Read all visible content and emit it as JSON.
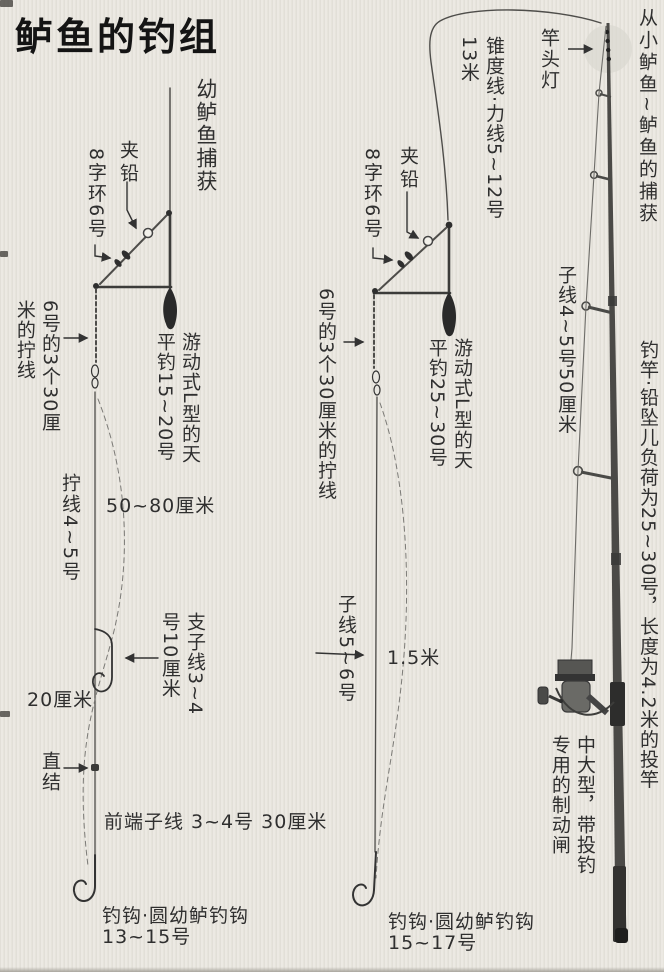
{
  "page": {
    "title": "鲈鱼的钓组"
  },
  "colors": {
    "paper": "#ebe8e1",
    "ink": "#2f2f2f",
    "line": "#4a4a4a",
    "rod": "#4b4a47"
  },
  "left_rig": {
    "catch_note": "幼鲈鱼捕获",
    "clamp_lead": "夹铅",
    "figure8_swivel": "8字环6号",
    "twist_segments": "6号的3个30厘米的拧线",
    "boom": "游动式L型的天平钓15~20号",
    "twist_line": "拧线4~5号",
    "span_upper": "50~80厘米",
    "branch_line": "支子线3~4号10厘米",
    "span_lower": "20厘米",
    "direct_knot": "直结",
    "front_leader": "前端子线 3~4号 30厘米",
    "hook_name": "钓钩·圆幼鲈钓钩",
    "hook_size": "13~15号"
  },
  "middle_rig": {
    "taper_line": "锥度线·力线5~12号13米",
    "clamp_lead": "夹铅",
    "figure8_swivel": "8字环6号",
    "twist_segments": "6号的3个30厘米的拧线",
    "boom": "游动式L型的天平钓25~30号",
    "sub_line": "子线5~6号",
    "span": "1.5米",
    "hook_name": "钓钩·圆幼鲈钓钩",
    "hook_size": "15~17号"
  },
  "rod": {
    "range_note": "从小鲈鱼~鲈鱼的捕获",
    "tip_light": "竿头灯",
    "sub_line": "子线4~5号50厘米",
    "rod_spec": "钓竿·铅坠儿负荷为25~30号，长度为4.2米的投竿",
    "reel_spec": "中大型，带投钓专用的制动闸"
  }
}
